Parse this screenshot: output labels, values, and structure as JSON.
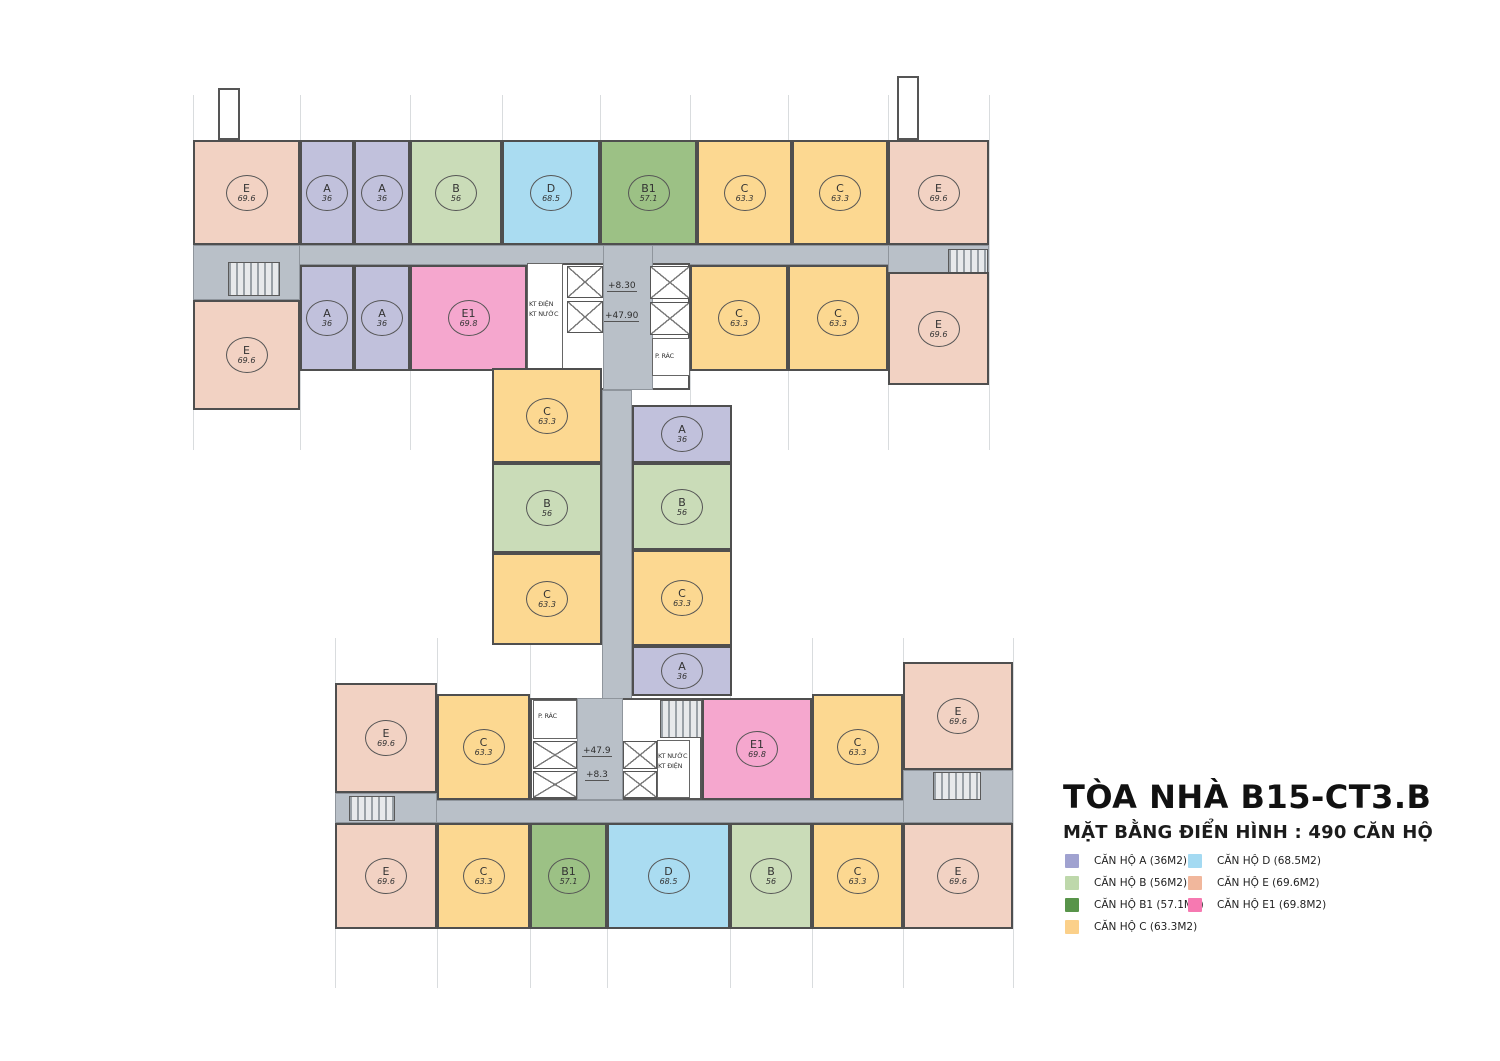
{
  "header": {
    "title": "TÒA NHÀ B15-CT3.B",
    "subtitle": "MẶT BẰNG ĐIỂN HÌNH : 490 CĂN HỘ"
  },
  "legend": [
    {
      "label": "CĂN HỘ A (36M2)",
      "color": "#a0a2d0",
      "col": 0,
      "row": 0
    },
    {
      "label": "CĂN HỘ B (56M2)",
      "color": "#bed8ab",
      "col": 0,
      "row": 1
    },
    {
      "label": "CĂN HỘ B1 (57.1M2)",
      "color": "#58944a",
      "col": 0,
      "row": 2
    },
    {
      "label": "CĂN HỘ C (63.3M2)",
      "color": "#fbd08a",
      "col": 0,
      "row": 3
    },
    {
      "label": "CĂN HỘ D (68.5M2)",
      "color": "#a4daf2",
      "col": 1,
      "row": 0
    },
    {
      "label": "CĂN HỘ E (69.6M2)",
      "color": "#f1b79c",
      "col": 1,
      "row": 1
    },
    {
      "label": "CĂN HỘ E1 (69.8M2)",
      "color": "#f679b1",
      "col": 1,
      "row": 2
    }
  ],
  "unit_types": {
    "A": {
      "area": "36",
      "fill": "#c1c1dc"
    },
    "B": {
      "area": "56",
      "fill": "#cadcb8"
    },
    "B1": {
      "area": "57.1",
      "fill": "#9cc185"
    },
    "C": {
      "area": "63.3",
      "fill": "#fcd891"
    },
    "D": {
      "area": "68.5",
      "fill": "#aadcf1"
    },
    "E": {
      "area": "69.6",
      "fill": "#f2d2c3"
    },
    "E1": {
      "area": "69.8",
      "fill": "#f5a7ce"
    }
  },
  "plan": {
    "gridlines": [
      {
        "x": 193,
        "y": 95,
        "h": 355
      },
      {
        "x": 300,
        "y": 95,
        "h": 355
      },
      {
        "x": 410,
        "y": 95,
        "h": 355
      },
      {
        "x": 502,
        "y": 95,
        "h": 355
      },
      {
        "x": 600,
        "y": 95,
        "h": 355
      },
      {
        "x": 690,
        "y": 95,
        "h": 355
      },
      {
        "x": 788,
        "y": 95,
        "h": 355
      },
      {
        "x": 888,
        "y": 95,
        "h": 355
      },
      {
        "x": 989,
        "y": 95,
        "h": 355
      },
      {
        "x": 335,
        "y": 638,
        "h": 350
      },
      {
        "x": 437,
        "y": 638,
        "h": 350
      },
      {
        "x": 530,
        "y": 638,
        "h": 350
      },
      {
        "x": 607,
        "y": 638,
        "h": 350
      },
      {
        "x": 730,
        "y": 638,
        "h": 350
      },
      {
        "x": 812,
        "y": 638,
        "h": 350
      },
      {
        "x": 903,
        "y": 638,
        "h": 350
      },
      {
        "x": 1013,
        "y": 638,
        "h": 350
      }
    ],
    "corridors": [
      {
        "x": 193,
        "y": 245,
        "w": 796,
        "h": 20
      },
      {
        "x": 193,
        "y": 245,
        "w": 107,
        "h": 55
      },
      {
        "x": 888,
        "y": 245,
        "w": 101,
        "h": 30
      },
      {
        "x": 335,
        "y": 800,
        "w": 678,
        "h": 23
      },
      {
        "x": 335,
        "y": 793,
        "w": 102,
        "h": 30
      },
      {
        "x": 903,
        "y": 770,
        "w": 110,
        "h": 53
      },
      {
        "x": 602,
        "y": 390,
        "w": 30,
        "h": 310
      }
    ],
    "cores": [
      {
        "x": 527,
        "y": 263,
        "w": 163,
        "h": 127
      },
      {
        "x": 530,
        "y": 698,
        "w": 172,
        "h": 102
      }
    ],
    "corridors_over": [
      {
        "x": 603,
        "y": 245,
        "w": 50,
        "h": 145
      },
      {
        "x": 577,
        "y": 698,
        "w": 46,
        "h": 102
      }
    ],
    "rooms": [
      {
        "x": 527,
        "y": 263,
        "w": 36,
        "h": 127
      },
      {
        "x": 652,
        "y": 338,
        "w": 38,
        "h": 38
      },
      {
        "x": 533,
        "y": 700,
        "w": 44,
        "h": 39
      },
      {
        "x": 657,
        "y": 740,
        "w": 33,
        "h": 58
      }
    ],
    "shafts": [
      {
        "x": 567,
        "y": 266,
        "w": 36,
        "h": 32
      },
      {
        "x": 567,
        "y": 301,
        "w": 36,
        "h": 32
      },
      {
        "x": 650,
        "y": 266,
        "w": 40,
        "h": 33
      },
      {
        "x": 650,
        "y": 302,
        "w": 40,
        "h": 33
      },
      {
        "x": 533,
        "y": 741,
        "w": 44,
        "h": 28
      },
      {
        "x": 533,
        "y": 771,
        "w": 44,
        "h": 27
      },
      {
        "x": 623,
        "y": 741,
        "w": 34,
        "h": 28
      },
      {
        "x": 623,
        "y": 771,
        "w": 34,
        "h": 27
      }
    ],
    "stairs": [
      {
        "x": 228,
        "y": 262,
        "w": 52,
        "h": 34
      },
      {
        "x": 948,
        "y": 249,
        "w": 40,
        "h": 26
      },
      {
        "x": 349,
        "y": 796,
        "w": 46,
        "h": 25
      },
      {
        "x": 933,
        "y": 772,
        "w": 48,
        "h": 28
      },
      {
        "x": 660,
        "y": 700,
        "w": 42,
        "h": 38
      }
    ],
    "towers": [
      {
        "x": 218,
        "y": 88,
        "w": 22,
        "h": 52
      },
      {
        "x": 897,
        "y": 76,
        "w": 22,
        "h": 64
      }
    ],
    "units": [
      {
        "t": "E",
        "x": 193,
        "y": 140,
        "w": 107,
        "h": 105
      },
      {
        "t": "A",
        "x": 300,
        "y": 140,
        "w": 54,
        "h": 105
      },
      {
        "t": "A",
        "x": 354,
        "y": 140,
        "w": 56,
        "h": 105
      },
      {
        "t": "B",
        "x": 410,
        "y": 140,
        "w": 92,
        "h": 105
      },
      {
        "t": "D",
        "x": 502,
        "y": 140,
        "w": 98,
        "h": 105
      },
      {
        "t": "B1",
        "x": 600,
        "y": 140,
        "w": 97,
        "h": 105
      },
      {
        "t": "C",
        "x": 697,
        "y": 140,
        "w": 95,
        "h": 105
      },
      {
        "t": "C",
        "x": 792,
        "y": 140,
        "w": 96,
        "h": 105
      },
      {
        "t": "E",
        "x": 888,
        "y": 140,
        "w": 101,
        "h": 105
      },
      {
        "t": "E",
        "x": 193,
        "y": 300,
        "w": 107,
        "h": 110
      },
      {
        "t": "A",
        "x": 300,
        "y": 265,
        "w": 54,
        "h": 106
      },
      {
        "t": "A",
        "x": 354,
        "y": 265,
        "w": 56,
        "h": 106
      },
      {
        "t": "E1",
        "x": 410,
        "y": 265,
        "w": 117,
        "h": 106
      },
      {
        "t": "C",
        "x": 690,
        "y": 265,
        "w": 98,
        "h": 106
      },
      {
        "t": "C",
        "x": 788,
        "y": 265,
        "w": 100,
        "h": 106
      },
      {
        "t": "E",
        "x": 888,
        "y": 272,
        "w": 101,
        "h": 113
      },
      {
        "t": "C",
        "x": 492,
        "y": 368,
        "w": 110,
        "h": 95
      },
      {
        "t": "B",
        "x": 492,
        "y": 463,
        "w": 110,
        "h": 90
      },
      {
        "t": "C",
        "x": 492,
        "y": 553,
        "w": 110,
        "h": 92
      },
      {
        "t": "A",
        "x": 632,
        "y": 405,
        "w": 100,
        "h": 58
      },
      {
        "t": "B",
        "x": 632,
        "y": 463,
        "w": 100,
        "h": 87
      },
      {
        "t": "C",
        "x": 632,
        "y": 550,
        "w": 100,
        "h": 96
      },
      {
        "t": "A",
        "x": 632,
        "y": 646,
        "w": 100,
        "h": 50
      },
      {
        "t": "E",
        "x": 335,
        "y": 683,
        "w": 102,
        "h": 110
      },
      {
        "t": "C",
        "x": 437,
        "y": 694,
        "w": 93,
        "h": 106
      },
      {
        "t": "E1",
        "x": 702,
        "y": 698,
        "w": 110,
        "h": 102
      },
      {
        "t": "C",
        "x": 812,
        "y": 694,
        "w": 91,
        "h": 106
      },
      {
        "t": "E",
        "x": 903,
        "y": 662,
        "w": 110,
        "h": 108
      },
      {
        "t": "E",
        "x": 335,
        "y": 823,
        "w": 102,
        "h": 106
      },
      {
        "t": "C",
        "x": 437,
        "y": 823,
        "w": 93,
        "h": 106
      },
      {
        "t": "B1",
        "x": 530,
        "y": 823,
        "w": 77,
        "h": 106
      },
      {
        "t": "D",
        "x": 607,
        "y": 823,
        "w": 123,
        "h": 106
      },
      {
        "t": "B",
        "x": 730,
        "y": 823,
        "w": 82,
        "h": 106
      },
      {
        "t": "C",
        "x": 812,
        "y": 823,
        "w": 91,
        "h": 106
      },
      {
        "t": "E",
        "x": 903,
        "y": 823,
        "w": 110,
        "h": 106
      }
    ],
    "annotations": [
      {
        "text": "+8.30",
        "x": 607,
        "y": 281,
        "kind": "level"
      },
      {
        "text": "+47.90",
        "x": 604,
        "y": 311,
        "kind": "level"
      },
      {
        "text": "+47.9",
        "x": 582,
        "y": 746,
        "kind": "level"
      },
      {
        "text": "+8.3",
        "x": 585,
        "y": 770,
        "kind": "level"
      },
      {
        "text": "P. RÁC",
        "x": 655,
        "y": 352,
        "kind": "room"
      },
      {
        "text": "P. RÁC",
        "x": 538,
        "y": 712,
        "kind": "room"
      },
      {
        "text": "KT ĐIỆN",
        "x": 529,
        "y": 300,
        "kind": "room"
      },
      {
        "text": "KT NƯỚC",
        "x": 529,
        "y": 310,
        "kind": "room"
      },
      {
        "text": "KT NƯỚC",
        "x": 658,
        "y": 752,
        "kind": "room"
      },
      {
        "text": "KT ĐIỆN",
        "x": 658,
        "y": 762,
        "kind": "room"
      }
    ]
  }
}
